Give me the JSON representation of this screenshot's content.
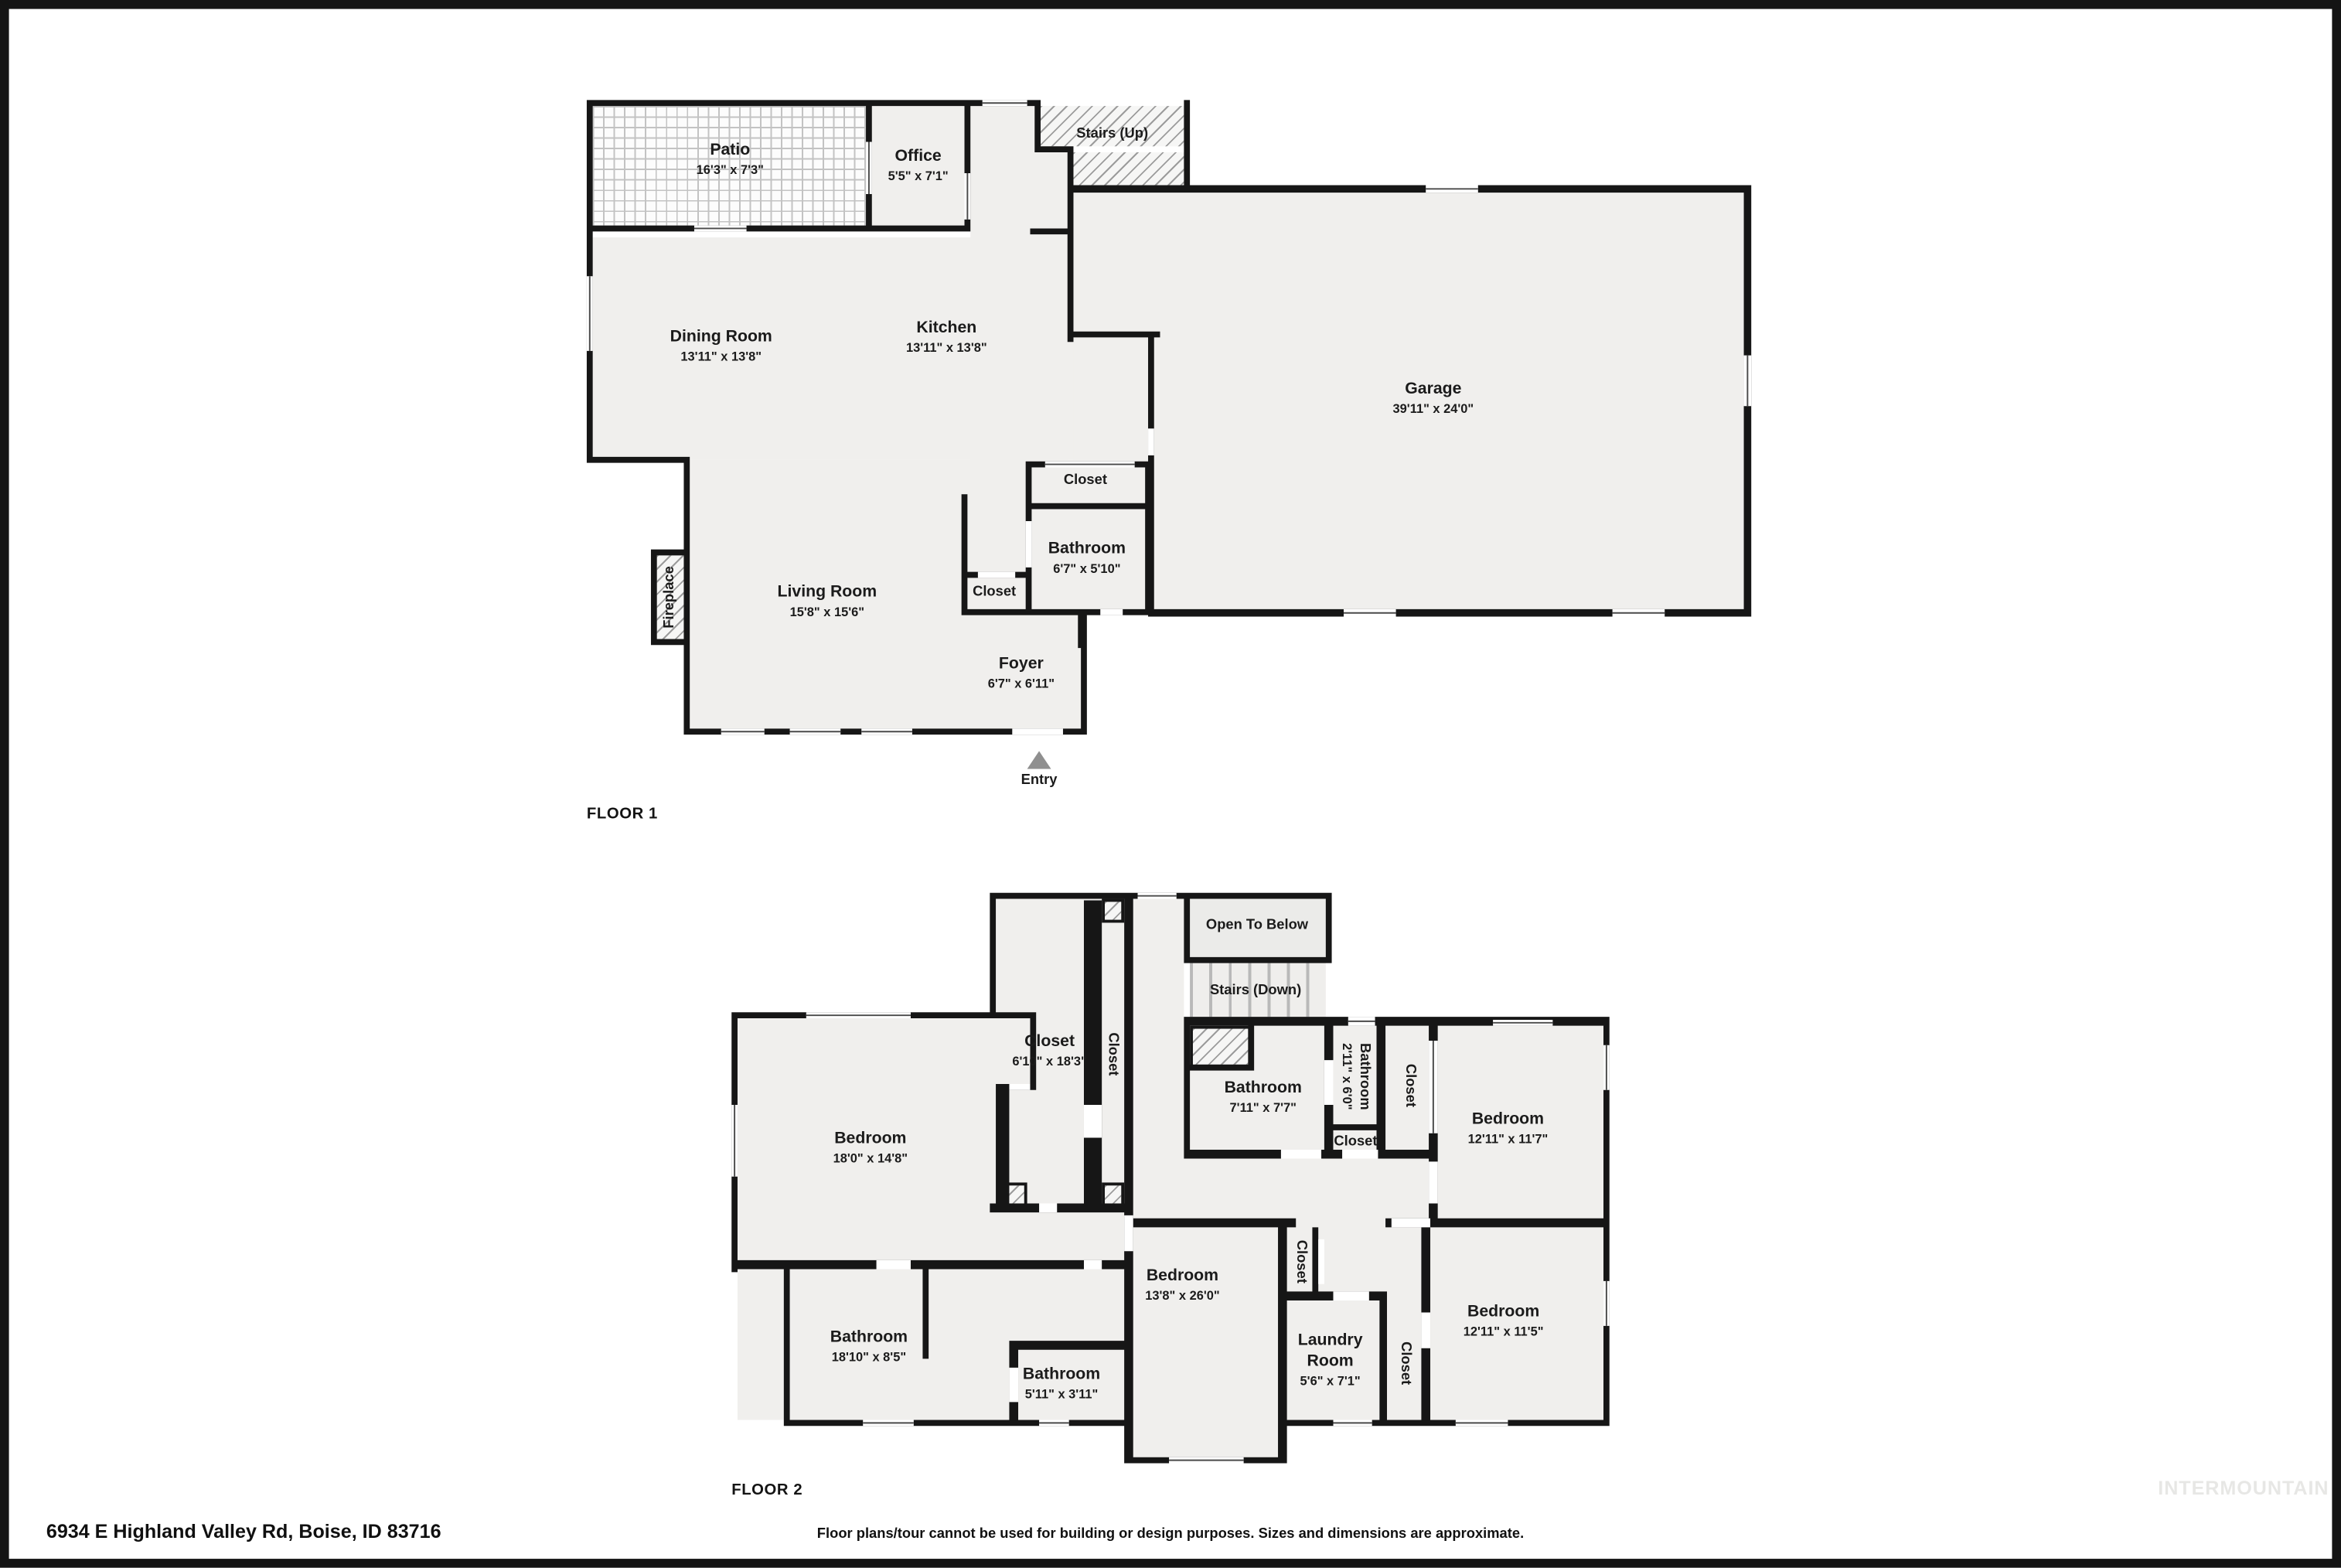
{
  "colors": {
    "wall": "#161616",
    "room_fill": "#f0efed",
    "hatch_line": "#9c9c9c",
    "label": "#1b1b1b",
    "watermark": "#e7e7e5",
    "entry_arrow": "#8f8f8f"
  },
  "floor1": {
    "label": "FLOOR 1",
    "entry_label": "Entry",
    "rooms": {
      "patio": {
        "n": "Patio",
        "d": "16'3\" x 7'3\""
      },
      "office": {
        "n": "Office",
        "d": "5'5\" x 7'1\""
      },
      "stairs": {
        "n": "Stairs (Up)"
      },
      "dining": {
        "n": "Dining Room",
        "d": "13'11\" x 13'8\""
      },
      "kitchen": {
        "n": "Kitchen",
        "d": "13'11\" x 13'8\""
      },
      "garage": {
        "n": "Garage",
        "d": "39'11\" x 24'0\""
      },
      "closet": {
        "n": "Closet"
      },
      "bath": {
        "n": "Bathroom",
        "d": "6'7\" x 5'10\""
      },
      "closet2": {
        "n": "Closet"
      },
      "living": {
        "n": "Living Room",
        "d": "15'8\" x 15'6\""
      },
      "fireplace": {
        "n": "Fireplace"
      },
      "foyer": {
        "n": "Foyer",
        "d": "6'7\" x 6'11\""
      }
    }
  },
  "floor2": {
    "label": "FLOOR 2",
    "rooms": {
      "walkin": {
        "n": "Closet",
        "d": "6'10\" x 18'3\""
      },
      "closet_n": {
        "n": "Closet"
      },
      "otb": {
        "n": "Open To Below"
      },
      "stairs": {
        "n": "Stairs (Down)"
      },
      "bath1": {
        "n": "Bathroom",
        "d": "7'11\" x 7'7\""
      },
      "bath2": {
        "n": "Bathroom",
        "d": "2'11\" x 6'0\""
      },
      "closet_ur": {
        "n": "Closet"
      },
      "closet_h": {
        "n": "Closet"
      },
      "bed_ur": {
        "n": "Bedroom",
        "d": "12'11\" x 11'7\""
      },
      "bed_l": {
        "n": "Bedroom",
        "d": "18'0\" x 14'8\""
      },
      "bed_c": {
        "n": "Bedroom",
        "d": "13'8\" x 26'0\""
      },
      "closet_c": {
        "n": "Closet"
      },
      "laundry": {
        "n": "Laundry Room",
        "d": "5'6\" x 7'1\""
      },
      "closet_l": {
        "n": "Closet"
      },
      "bed_lr": {
        "n": "Bedroom",
        "d": "12'11\" x 11'5\""
      },
      "bath_big": {
        "n": "Bathroom",
        "d": "18'10\" x 8'5\""
      },
      "bath_sm": {
        "n": "Bathroom",
        "d": "5'11\" x 3'11\""
      }
    }
  },
  "footer": {
    "address": "6934 E Highland Valley Rd, Boise, ID 83716",
    "disclaimer": "Floor plans/tour cannot be used for building or design purposes. Sizes and dimensions are approximate.",
    "watermark": "INTERMOUNTAIN"
  }
}
